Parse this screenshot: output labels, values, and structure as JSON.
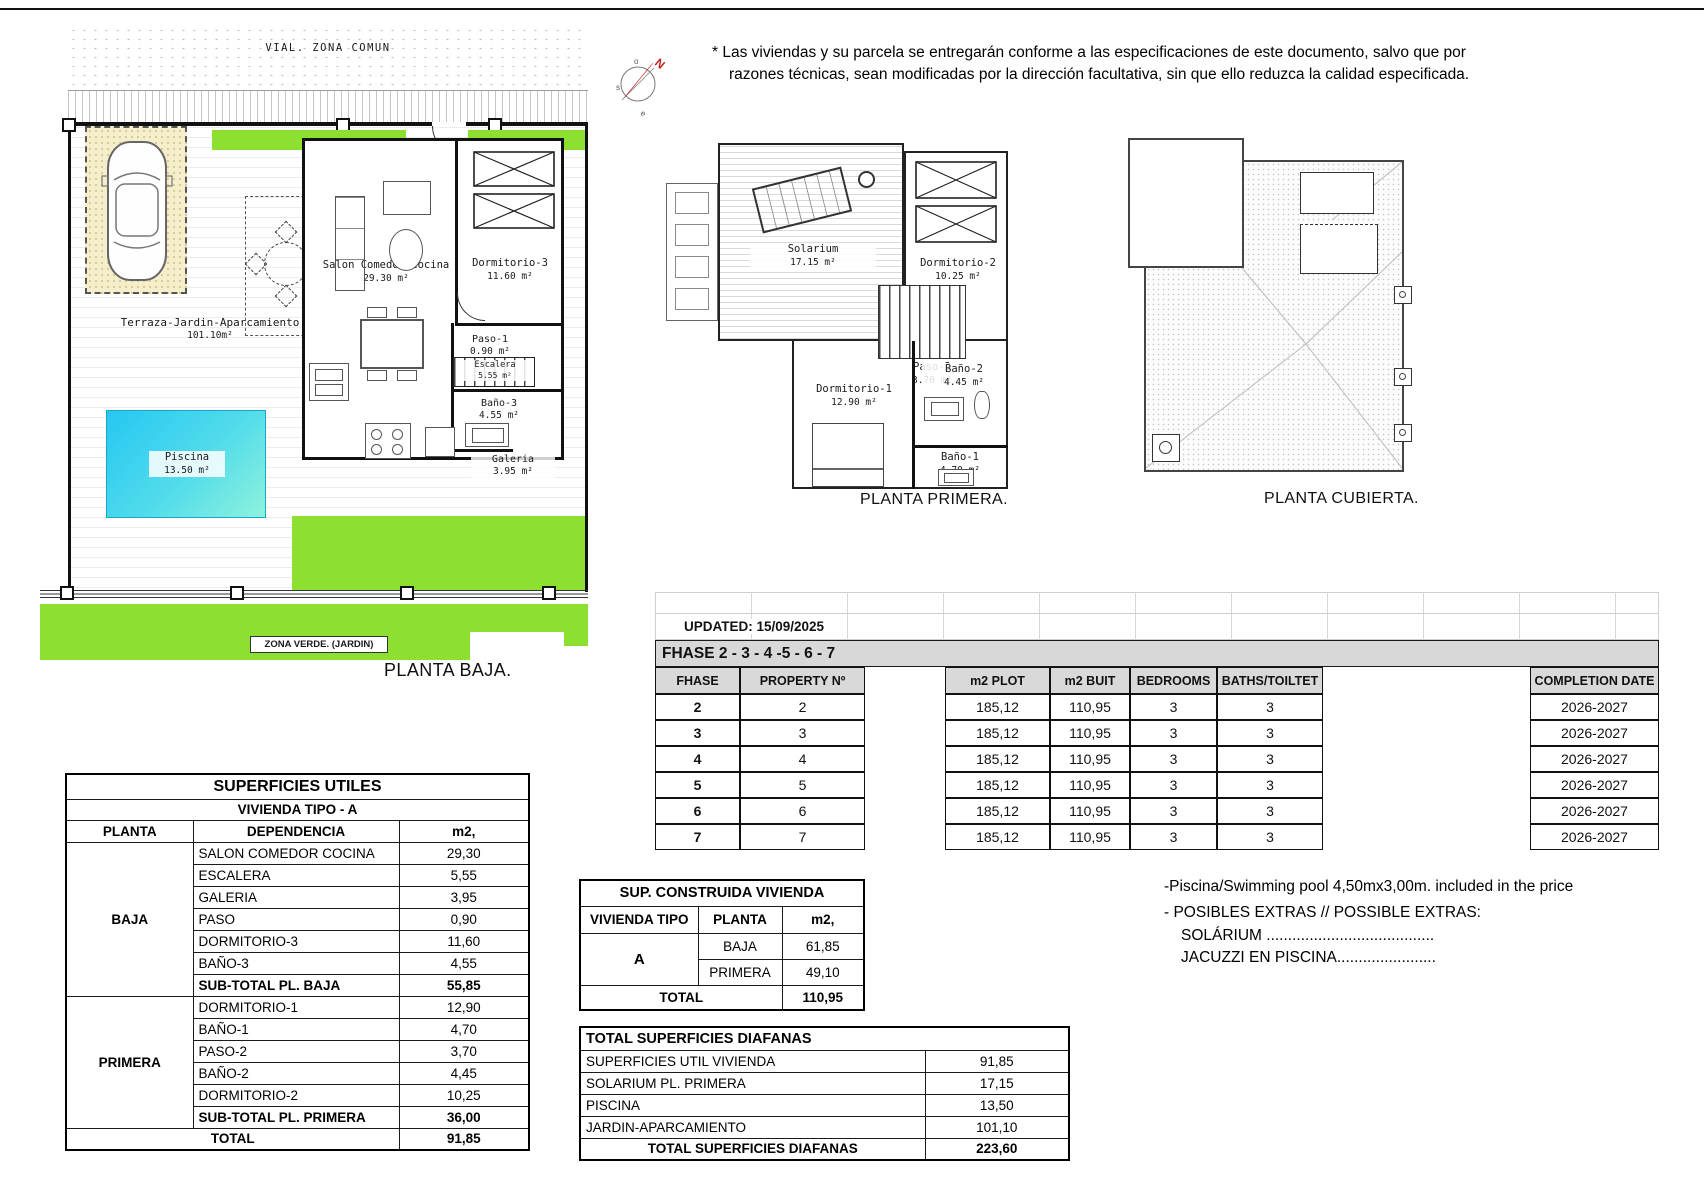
{
  "page": {
    "disclaimer_line1": "* Las viviendas y su parcela se entregarán conforme a las especificaciones de este documento, salvo que por",
    "disclaimer_line2": "razones técnicas, sean modificadas por la dirección facultativa, sin que ello reduzca la calidad especificada."
  },
  "compass": {
    "n": "N",
    "o": "o",
    "s": "s",
    "e": "e"
  },
  "plan_baja": {
    "street": "VIAL. ZONA COMUN",
    "terrace_name": "Terraza-Jardin-Aparcamiento",
    "terrace_area": "101.10m²",
    "pool_name": "Piscina",
    "pool_area": "13.50 m²",
    "salon_name": "Salon Comedor Cocina",
    "salon_area": "29.30 m²",
    "dorm3_name": "Dormitorio-3",
    "dorm3_area": "11.60 m²",
    "paso1_name": "Paso-1",
    "paso1_area": "0.90 m²",
    "escalera_name": "Escalera",
    "escalera_area": "5.55 m²",
    "bano3_name": "Baño-3",
    "bano3_area": "4.55 m²",
    "galeria_name": "Galeria",
    "galeria_area": "3.95 m²",
    "green_label": "ZONA VERDE. (JARDIN)",
    "caption": "PLANTA BAJA."
  },
  "plan_primera": {
    "solarium_name": "Solarium",
    "solarium_area": "17.15 m²",
    "dorm2_name": "Dormitorio-2",
    "dorm2_area": "10.25 m²",
    "paso2_name": "Paso-2",
    "paso2_area": "3.70 m²",
    "dorm1_name": "Dormitorio-1",
    "dorm1_area": "12.90 m²",
    "bano2_name": "Baño-2",
    "bano2_area": "4.45 m²",
    "bano1_name": "Baño-1",
    "bano1_area": "4.70 m²",
    "caption": "PLANTA PRIMERA."
  },
  "plan_cubierta": {
    "caption": "PLANTA CUBIERTA."
  },
  "fhase_table": {
    "updated": "UPDATED: 15/09/2025",
    "title": "FHASE  2 - 3 - 4 -5 - 6 - 7",
    "h_fhase": "FHASE",
    "h_property": "PROPERTY Nº",
    "h_plot": "m2 PLOT",
    "h_built": "m2 BUIT",
    "h_bedrooms": "BEDROOMS",
    "h_baths": "BATHS/TOILTET",
    "h_completion": "COMPLETION DATE",
    "rows": [
      {
        "fhase": "2",
        "property": "2",
        "plot": "185,12",
        "built": "110,95",
        "bedrooms": "3",
        "baths": "3",
        "completion": "2026-2027"
      },
      {
        "fhase": "3",
        "property": "3",
        "plot": "185,12",
        "built": "110,95",
        "bedrooms": "3",
        "baths": "3",
        "completion": "2026-2027"
      },
      {
        "fhase": "4",
        "property": "4",
        "plot": "185,12",
        "built": "110,95",
        "bedrooms": "3",
        "baths": "3",
        "completion": "2026-2027"
      },
      {
        "fhase": "5",
        "property": "5",
        "plot": "185,12",
        "built": "110,95",
        "bedrooms": "3",
        "baths": "3",
        "completion": "2026-2027"
      },
      {
        "fhase": "6",
        "property": "6",
        "plot": "185,12",
        "built": "110,95",
        "bedrooms": "3",
        "baths": "3",
        "completion": "2026-2027"
      },
      {
        "fhase": "7",
        "property": "7",
        "plot": "185,12",
        "built": "110,95",
        "bedrooms": "3",
        "baths": "3",
        "completion": "2026-2027"
      }
    ]
  },
  "superficies_utiles": {
    "title": "SUPERFICIES UTILES",
    "subtitle": "VIVIENDA TIPO - A",
    "h_planta": "PLANTA",
    "h_dependencia": "DEPENDENCIA",
    "h_m2": "m2,",
    "baja_label": "BAJA",
    "baja_rows": [
      {
        "label": "SALON COMEDOR COCINA",
        "value": "29,30"
      },
      {
        "label": "ESCALERA",
        "value": "5,55"
      },
      {
        "label": "GALERIA",
        "value": "3,95"
      },
      {
        "label": "PASO",
        "value": "0,90"
      },
      {
        "label": "DORMITORIO-3",
        "value": "11,60"
      },
      {
        "label": "BAÑO-3",
        "value": "4,55"
      }
    ],
    "baja_subtotal_label": "SUB-TOTAL PL. BAJA",
    "baja_subtotal": "55,85",
    "primera_label": "PRIMERA",
    "primera_rows": [
      {
        "label": "DORMITORIO-1",
        "value": "12,90"
      },
      {
        "label": "BAÑO-1",
        "value": "4,70"
      },
      {
        "label": "PASO-2",
        "value": "3,70"
      },
      {
        "label": "BAÑO-2",
        "value": "4,45"
      },
      {
        "label": "DORMITORIO-2",
        "value": "10,25"
      }
    ],
    "primera_subtotal_label": "SUB-TOTAL PL. PRIMERA",
    "primera_subtotal": "36,00",
    "total_label": "TOTAL",
    "total": "91,85"
  },
  "sup_construida": {
    "title": "SUP. CONSTRUIDA VIVIENDA",
    "h_tipo": "VIVIENDA TIPO",
    "h_planta": "PLANTA",
    "h_m2": "m2,",
    "tipo": "A",
    "row_baja_label": "BAJA",
    "row_baja_value": "61,85",
    "row_primera_label": "PRIMERA",
    "row_primera_value": "49,10",
    "total_label": "TOTAL",
    "total": "110,95"
  },
  "diafanas": {
    "title": "TOTAL SUPERFICIES DIAFANAS",
    "rows": [
      {
        "label": "SUPERFICIES UTIL VIVIENDA",
        "value": "91,85"
      },
      {
        "label": "SOLARIUM PL. PRIMERA",
        "value": "17,15"
      },
      {
        "label": "PISCINA",
        "value": "13,50"
      },
      {
        "label": "JARDIN-APARCAMIENTO",
        "value": "101,10"
      }
    ],
    "total_label": "TOTAL SUPERFICIES DIAFANAS",
    "total": "223,60"
  },
  "notes": {
    "line1": "-Piscina/Swimming pool 4,50mx3,00m. included in the price",
    "line2": "- POSIBLES EXTRAS // POSSIBLE EXTRAS:",
    "line3": "SOLÁRIUM .......................................",
    "line4": "JACUZZI EN PISCINA......................."
  }
}
